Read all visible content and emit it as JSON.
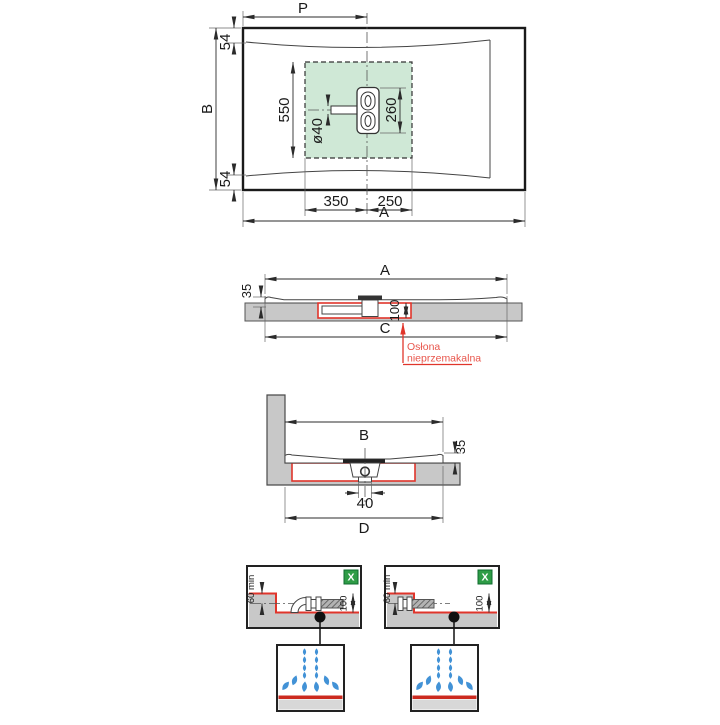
{
  "drawing": {
    "top_view": {
      "dim_width_to_drain": "P",
      "dim_depth": "B",
      "dim_length": "A",
      "dim_edge_top": "54",
      "dim_edge_bottom": "54",
      "dim_zone_height": "550",
      "dim_pipe_diameter": "ø40",
      "dim_drain_length": "260",
      "dim_drain_offset_left": "350",
      "dim_drain_offset_right": "250"
    },
    "side_view_length": {
      "dim_length": "A",
      "dim_tray_height": "35",
      "dim_recess_depth": "100",
      "dim_cutout_length": "C",
      "waterproof_label_line1": "Osłona",
      "waterproof_label_line2": "nieprzemakalna"
    },
    "side_view_width": {
      "dim_width": "B",
      "dim_tray_height": "35",
      "dim_outlet_diameter": "40",
      "dim_cutout_width": "D"
    },
    "install_details": {
      "left": {
        "badge": "X",
        "dim_min_depth": "60 min",
        "dim_recess_depth": "100"
      },
      "right": {
        "badge": "X",
        "dim_min_depth": "60 min",
        "dim_recess_depth": "100"
      }
    },
    "colors": {
      "accent_red": "#e0352b",
      "label_red": "#e8554b",
      "zone_green_fill": "#cfe8d6",
      "badge_green": "#2e9c46",
      "drop_blue": "#4292d6",
      "concrete_gray": "#c8c8c8"
    }
  }
}
